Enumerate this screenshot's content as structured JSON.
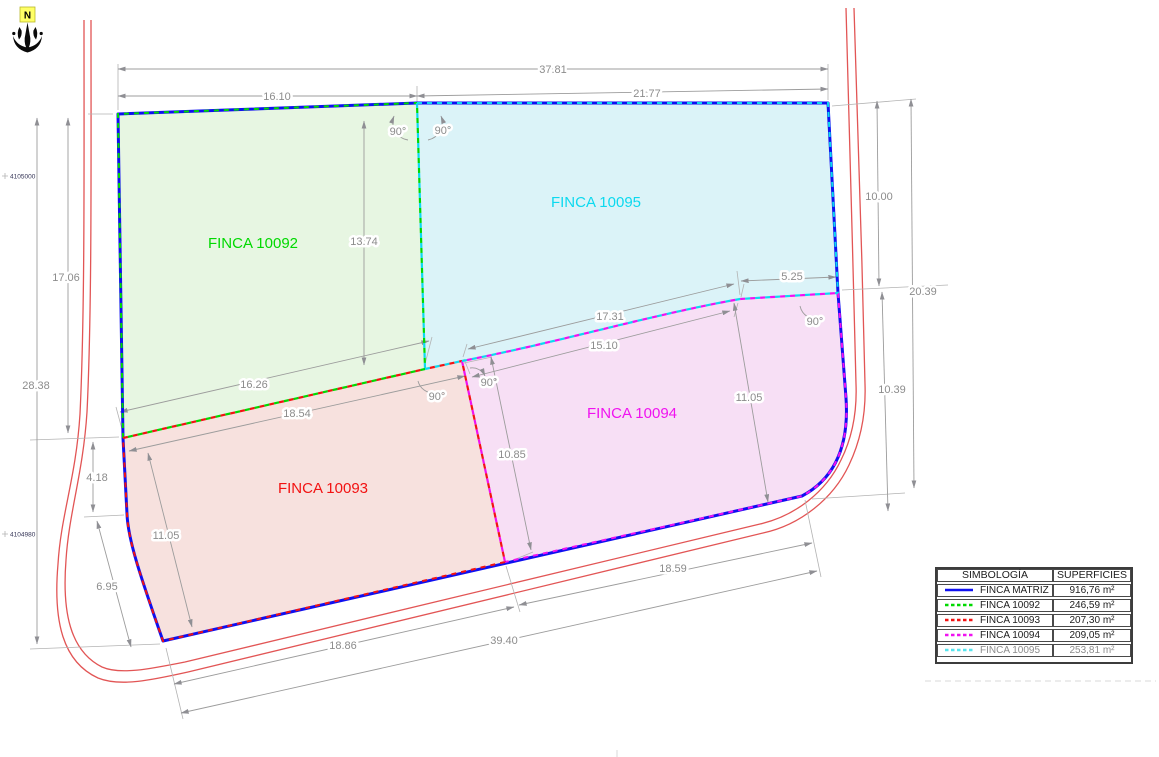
{
  "north": {
    "label": "N"
  },
  "coords": {
    "top": "4105000",
    "bottom": "4104980"
  },
  "parcels": {
    "matriz": {
      "label": "FINCA MATRIZ",
      "color": "#0f10f0"
    },
    "p10092": {
      "label": "FINCA 10092",
      "color": "#00d900"
    },
    "p10093": {
      "label": "FINCA 10093",
      "color": "#f21212"
    },
    "p10094": {
      "label": "FINCA 10094",
      "color": "#f012f0"
    },
    "p10095": {
      "label": "FINCA 10095",
      "color": "#0cd9ef"
    }
  },
  "dims": {
    "top_total": "37.81",
    "top_left": "16.10",
    "top_right": "21.77",
    "left_upper": "17.06",
    "left_total": "28.38",
    "left_small": "4.18",
    "left_lower": "6.95",
    "divider_1092_1095": "13.74",
    "right_upper": "10.00",
    "right_total": "20.39",
    "right_lower": "10.39",
    "right_top_offset": "5.25",
    "mid_upper": "17.31",
    "mid_lower": "15.10",
    "green_red_upper": "16.26",
    "green_red_lower": "18.54",
    "divider_1093_1094": "10.85",
    "p94_height": "11.05",
    "p93_height": "11.05",
    "bottom_left": "18.86",
    "bottom_right": "18.59",
    "bottom_total": "39.40",
    "angle": "90°"
  },
  "legend": {
    "header_symbol": "SIMBOLOGÍA",
    "header_area": "SUPERFICIES",
    "rows": [
      {
        "name": "FINCA MATRIZ",
        "area": "916,76 m²",
        "color": "#0f10f0"
      },
      {
        "name": "FINCA 10092",
        "area": "246,59 m²",
        "color": "#00d900"
      },
      {
        "name": "FINCA 10093",
        "area": "207,30 m²",
        "color": "#f21212"
      },
      {
        "name": "FINCA 10094",
        "area": "209,05 m²",
        "color": "#f012f0"
      },
      {
        "name": "FINCA 10095",
        "area": "253,81 m²",
        "color": "#57e5ee"
      }
    ]
  }
}
